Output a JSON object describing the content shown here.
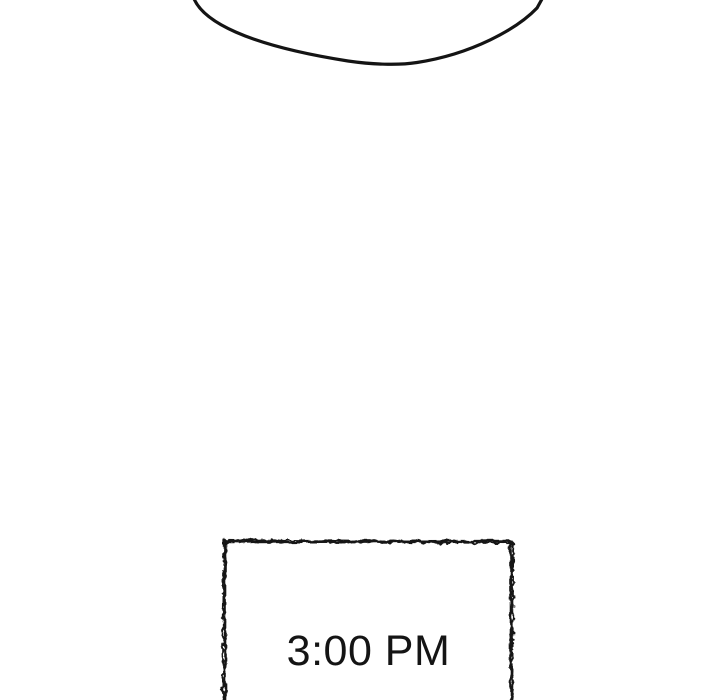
{
  "page": {
    "background_color": "#ffffff",
    "ink_color": "#141414"
  },
  "time_box": {
    "label": "3:00 PM"
  }
}
